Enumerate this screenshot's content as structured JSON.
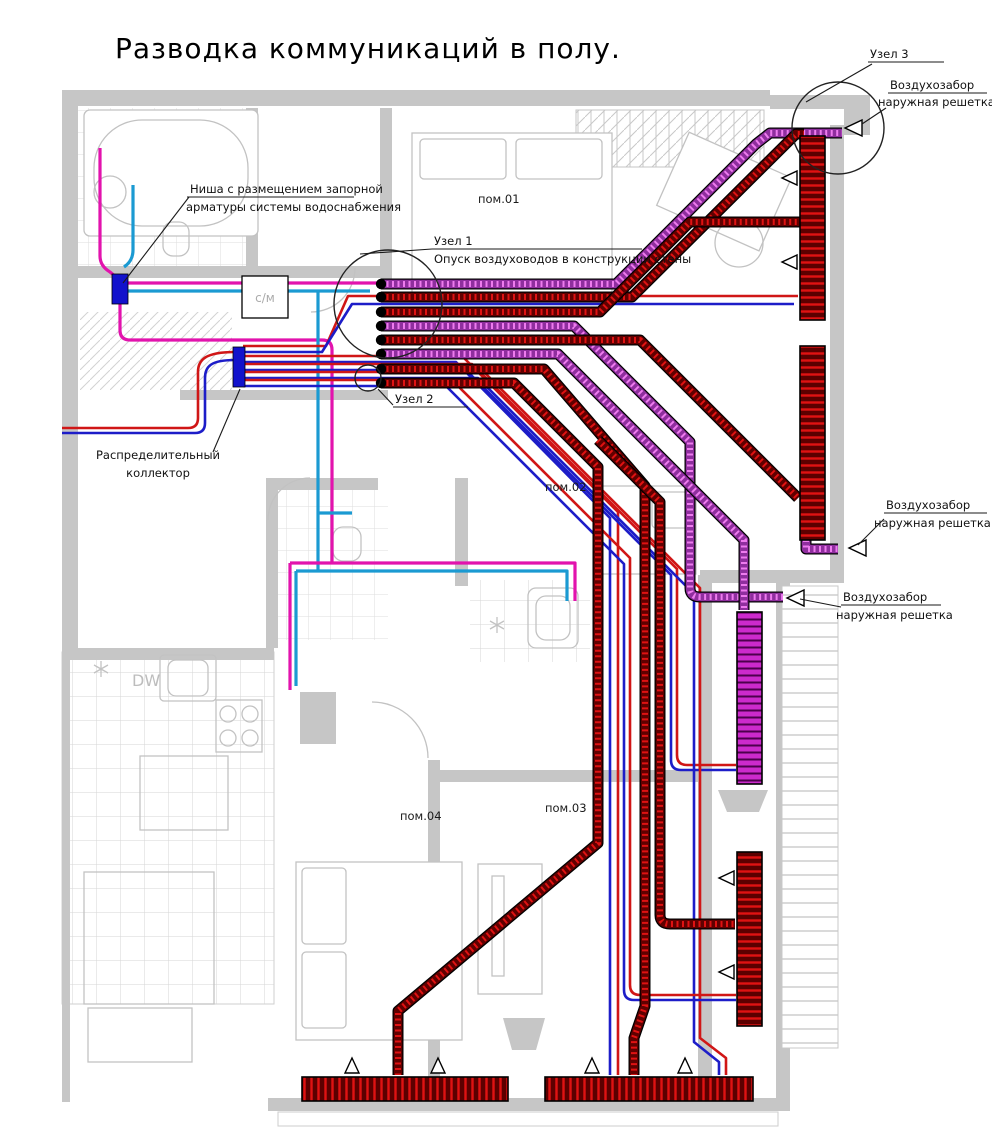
{
  "title": "Разводка коммуникаций в полу.",
  "nodes": {
    "uzel1": "Узел 1",
    "uzel2": "Узел 2",
    "uzel3": "Узел 3"
  },
  "callouts": {
    "duct_drop": "Опуск воздуховодов в конструкции стены",
    "intake_line1": "Воздухозабор",
    "intake_line2": "наружная решетка",
    "niche_line1": "Ниша с размещением запорной",
    "niche_line2": "арматуры системы водоснабжения",
    "manifold_line1": "Распределительный",
    "manifold_line2": "коллектор"
  },
  "rooms": {
    "r1": "пом.01",
    "r2": "пом.02",
    "r3": "пом.03",
    "r4": "пом.04"
  },
  "equipment": {
    "washing_machine": "с/м",
    "dishwasher": "DW"
  },
  "colors": {
    "duct_dark": "#600000",
    "duct_hatch": "#e01212",
    "violet_dark": "#8f2e9e",
    "violet_hatch": "#ee7bee",
    "pipe_red": "#d01616",
    "pipe_blue": "#1d1dc8",
    "pipe_cyan": "#1b9ad2",
    "pipe_magenta": "#e213ad",
    "fitting_blue": "#1212cc",
    "wall": "#c6c6c6"
  }
}
